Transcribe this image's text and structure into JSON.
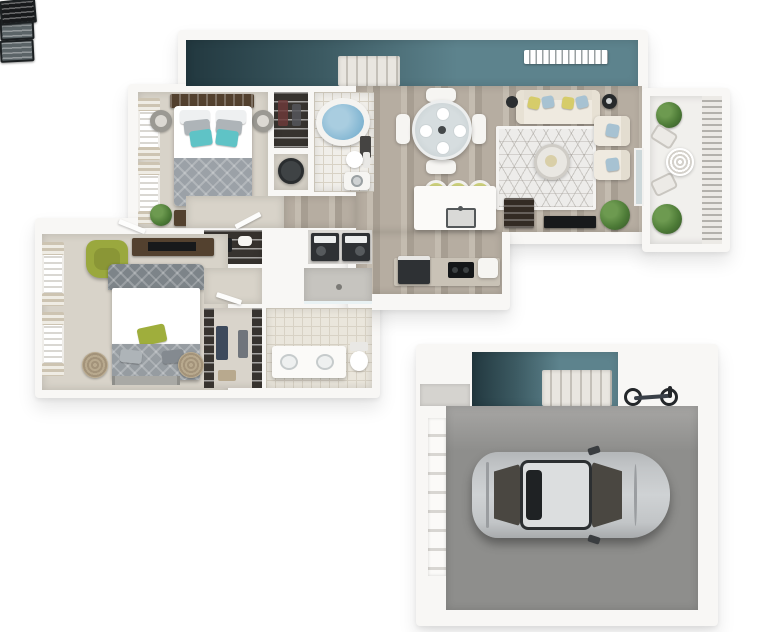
{
  "meta": {
    "image_type": "3d-floor-plan-render",
    "units": [
      "two-bedroom-apartment",
      "single-car-garage"
    ],
    "counts": {
      "bedrooms": 2,
      "bathrooms": 2,
      "bar_stools": 3,
      "dining_chairs": 4,
      "balcony_plants": 2,
      "cars": 1,
      "bicycles": 1
    }
  },
  "palette": {
    "background": "#ffffff",
    "wall": "#f8f7f5",
    "accent_teal": "#5d838d",
    "accent_teal_dark": "#22383f",
    "wood_floor": "#b6ada1",
    "wood_floor_light": "#c4bcb0",
    "wood_floor_dark": "#a79e92",
    "carpet_beige": "#d8d3c9",
    "tile": "#eae6dc",
    "tile_line": "#d8d2c5",
    "garage_floor": "#8e8e8c",
    "garage_floor_light": "#a7a6a4",
    "rug": "#edecea",
    "sofa_cream": "#efeae0",
    "pillow_yellow": "#d6cc6a",
    "pillow_blue": "#a7c2d2",
    "pillow_teal": "#5fc3c6",
    "pillow_green": "#9fae3c",
    "duvet_gray": "#9ba1a7",
    "headboard_gray": "#7d8489",
    "dark_wood": "#53412f",
    "tv_black": "#17191b",
    "appliance_dark": "#2e3134",
    "plant_green": "#4c7a36",
    "water_blue": "#84b7d3",
    "car_silver": "#c2c5c7",
    "car_roof": "#dcdedf",
    "car_glass": "#4a4741",
    "stool_yellow": "#ccd07c",
    "pouf_tan": "#b8a98e",
    "chair_green": "#9aa83e",
    "counter_taupe": "#c9c2b6",
    "closet_dark": "#37332f",
    "steel_gray": "#3f4345"
  },
  "apartment": {
    "rooms": [
      {
        "name": "entry-stair-hall",
        "floor": "teal-accent",
        "features": [
          "staircase",
          "ceiling-vent",
          "skylight",
          "skylight",
          "window-band"
        ]
      },
      {
        "name": "living-room",
        "floor": "wood",
        "furniture": [
          "sofa",
          "area-rug",
          "round-coffee-table",
          "armchair",
          "armchair",
          "floor-lamp",
          "side-table",
          "wall-tv",
          "wine-cabinet",
          "floor-plant",
          "sliding-glass-door"
        ]
      },
      {
        "name": "dining-area",
        "floor": "wood",
        "furniture": [
          "round-glass-table",
          "dining-chair",
          "dining-chair",
          "dining-chair",
          "dining-chair",
          "place-settings"
        ]
      },
      {
        "name": "kitchen",
        "floor": "wood",
        "furniture": [
          "island-with-sink",
          "bar-stool",
          "bar-stool",
          "bar-stool",
          "range",
          "cooktop",
          "counter"
        ]
      },
      {
        "name": "bedroom-2",
        "floor": "carpet",
        "furniture": [
          "queen-bed",
          "teal-accent-pillows",
          "headboard",
          "nightstand",
          "nightstand",
          "dresser-with-tv",
          "plant",
          "window",
          "window"
        ]
      },
      {
        "name": "bathroom-2",
        "floor": "tile",
        "fixtures": [
          "garden-tub",
          "toilet",
          "washer",
          "towel-rack"
        ]
      },
      {
        "name": "reach-in-closet",
        "floor": "dark",
        "features": [
          "wire-shelving"
        ]
      },
      {
        "name": "utility-closet",
        "fixtures": [
          "water-heater"
        ]
      },
      {
        "name": "laundry-closet",
        "fixtures": [
          "washer",
          "dryer"
        ]
      },
      {
        "name": "hallway",
        "floor": "carpet-and-wood"
      },
      {
        "name": "linen-closet",
        "features": [
          "wire-shelving"
        ]
      },
      {
        "name": "master-bedroom",
        "floor": "carpet",
        "furniture": [
          "king-bed",
          "green-accent-pillow",
          "green-armchair",
          "media-console-with-tv",
          "pouf",
          "pouf",
          "runner-rug",
          "window",
          "window"
        ]
      },
      {
        "name": "walk-in-closet",
        "features": [
          "wire-shelving",
          "clothes",
          "baskets"
        ]
      },
      {
        "name": "master-bathroom",
        "floor": "tile",
        "fixtures": [
          "double-vanity",
          "toilet",
          "walk-in-shower"
        ]
      },
      {
        "name": "balcony",
        "features": [
          "slat-railing",
          "bistro-table",
          "bistro-chair",
          "bistro-chair",
          "plant",
          "plant"
        ]
      }
    ]
  },
  "garage": {
    "rooms": [
      {
        "name": "garage-entry",
        "floor": "teal-accent",
        "features": [
          "staircase",
          "ceiling-vent",
          "landing",
          "entry-stoop"
        ]
      },
      {
        "name": "garage-bay",
        "floor": "concrete",
        "contents": [
          "sedan-car",
          "bicycle",
          "panel-garage-door"
        ]
      }
    ]
  }
}
